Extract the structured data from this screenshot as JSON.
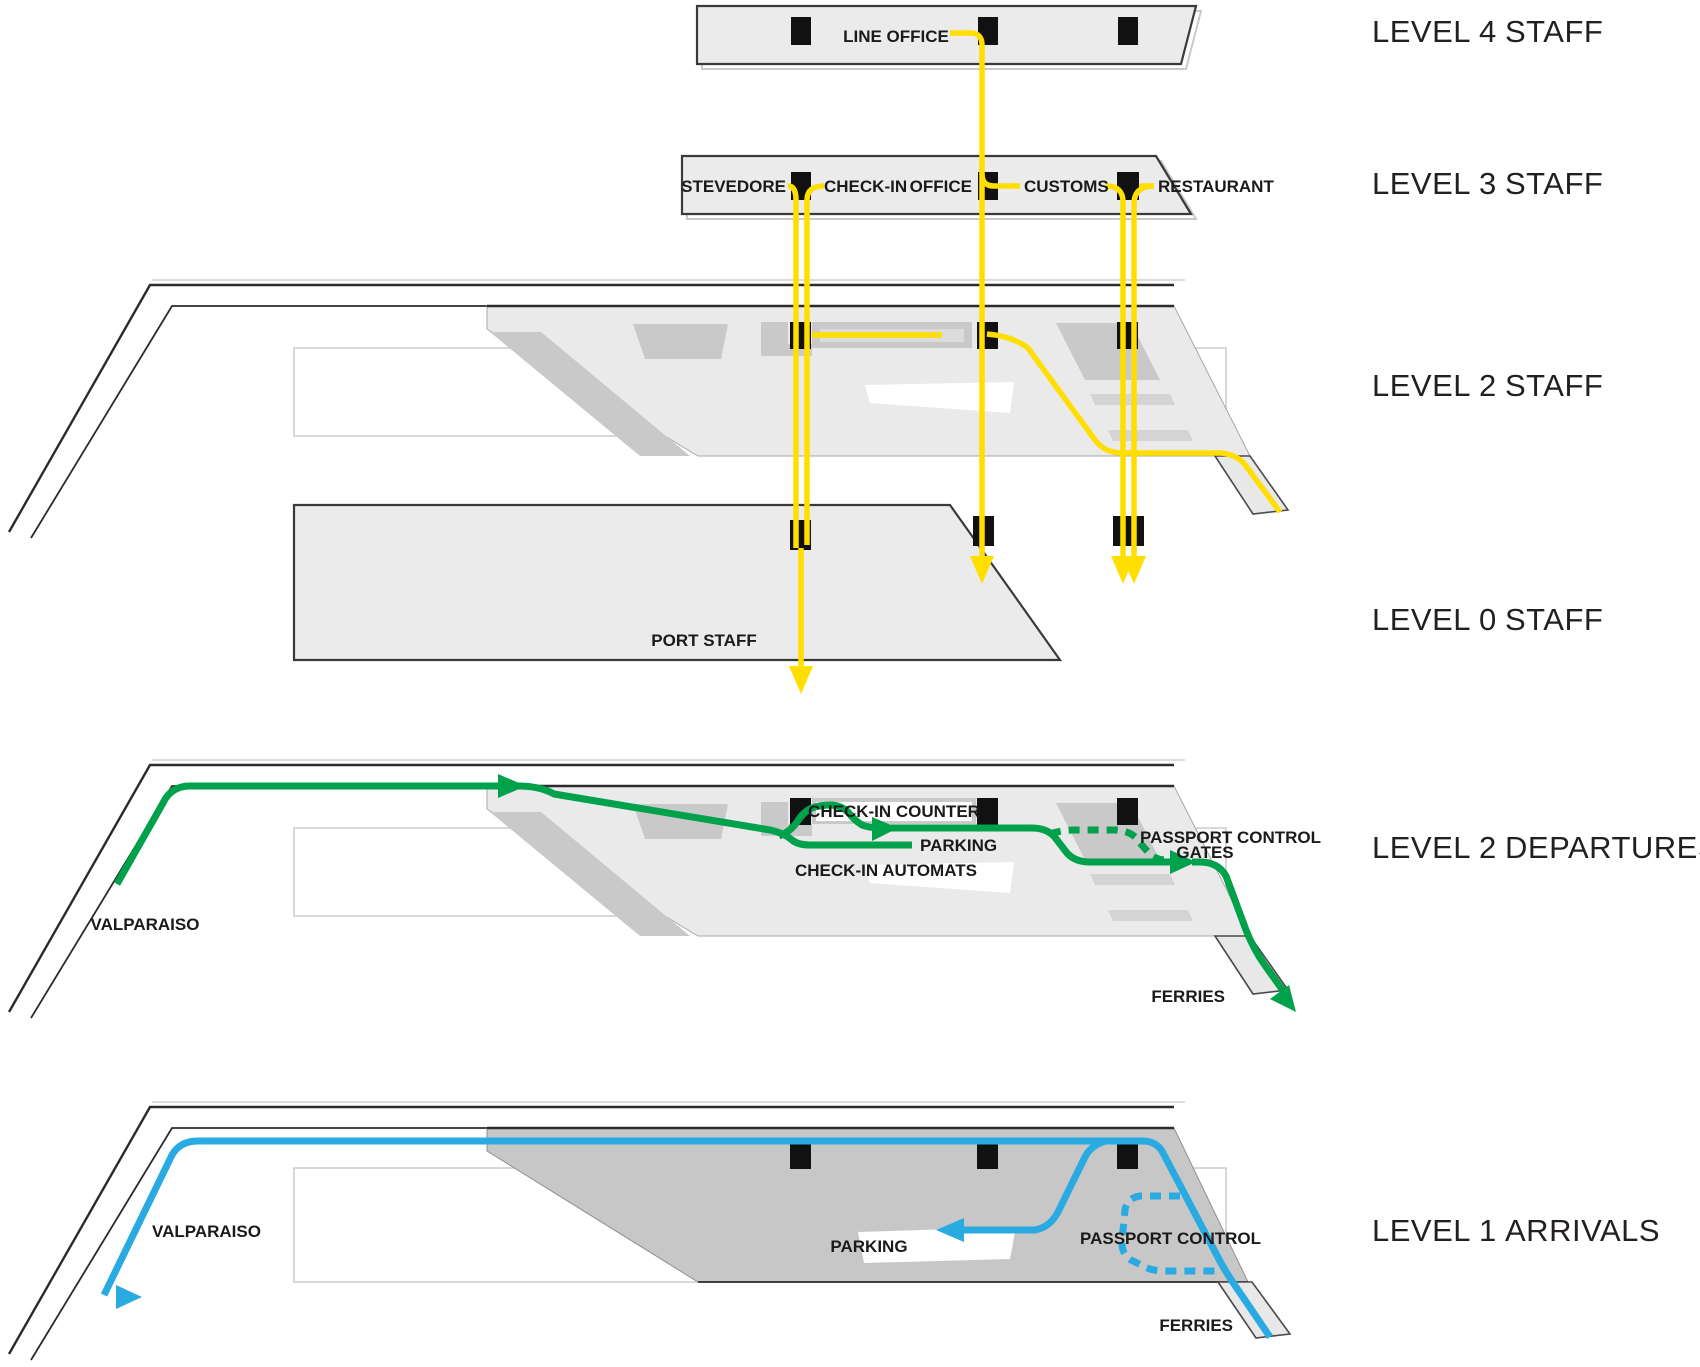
{
  "title": "Ferry terminal level circulation diagram",
  "colors": {
    "staff_route": "#FFDE00",
    "departures_route": "#00A14B",
    "arrivals_route": "#29ABE2",
    "floor_light": "#EAEAEA",
    "floor_patch": "#C9C9C9",
    "floor_dark": "#C7C7C7",
    "core": "#111111"
  },
  "levels": {
    "l4": {
      "name": "LEVEL 4",
      "cat": "STAFF",
      "line_office": "LINE OFFICE"
    },
    "l3": {
      "name": "LEVEL 3",
      "cat": "STAFF",
      "stevedore": "STEVEDORE",
      "check_in": "CHECK-IN",
      "office": "OFFICE",
      "customs": "CUSTOMS",
      "restaurant": "RESTAURANT"
    },
    "l2s": {
      "name": "LEVEL 2",
      "cat": "STAFF"
    },
    "l0": {
      "name": "LEVEL 0",
      "cat": "STAFF",
      "port_staff": "PORT STAFF"
    },
    "l2d": {
      "name": "LEVEL 2",
      "cat": "DEPARTURES",
      "check_in_counter": "CHECK-IN COUNTER",
      "parking": "PARKING",
      "check_in_automats": "CHECK-IN AUTOMATS",
      "passport_control": "PASSPORT CONTROL",
      "gates": "GATES",
      "valparaiso": "VALPARAISO",
      "ferries": "FERRIES"
    },
    "l1a": {
      "name": "LEVEL 1",
      "cat": "ARRIVALS",
      "parking": "PARKING",
      "passport_control": "PASSPORT CONTROL",
      "valparaiso": "VALPARAISO",
      "ferries": "FERRIES"
    }
  },
  "routes": {
    "staff": {
      "name": "staff circulation",
      "color": "#FFDE00"
    },
    "departures": {
      "name": "departures circulation",
      "color": "#00A14B"
    },
    "arrivals": {
      "name": "arrivals circulation",
      "color": "#29ABE2"
    }
  }
}
